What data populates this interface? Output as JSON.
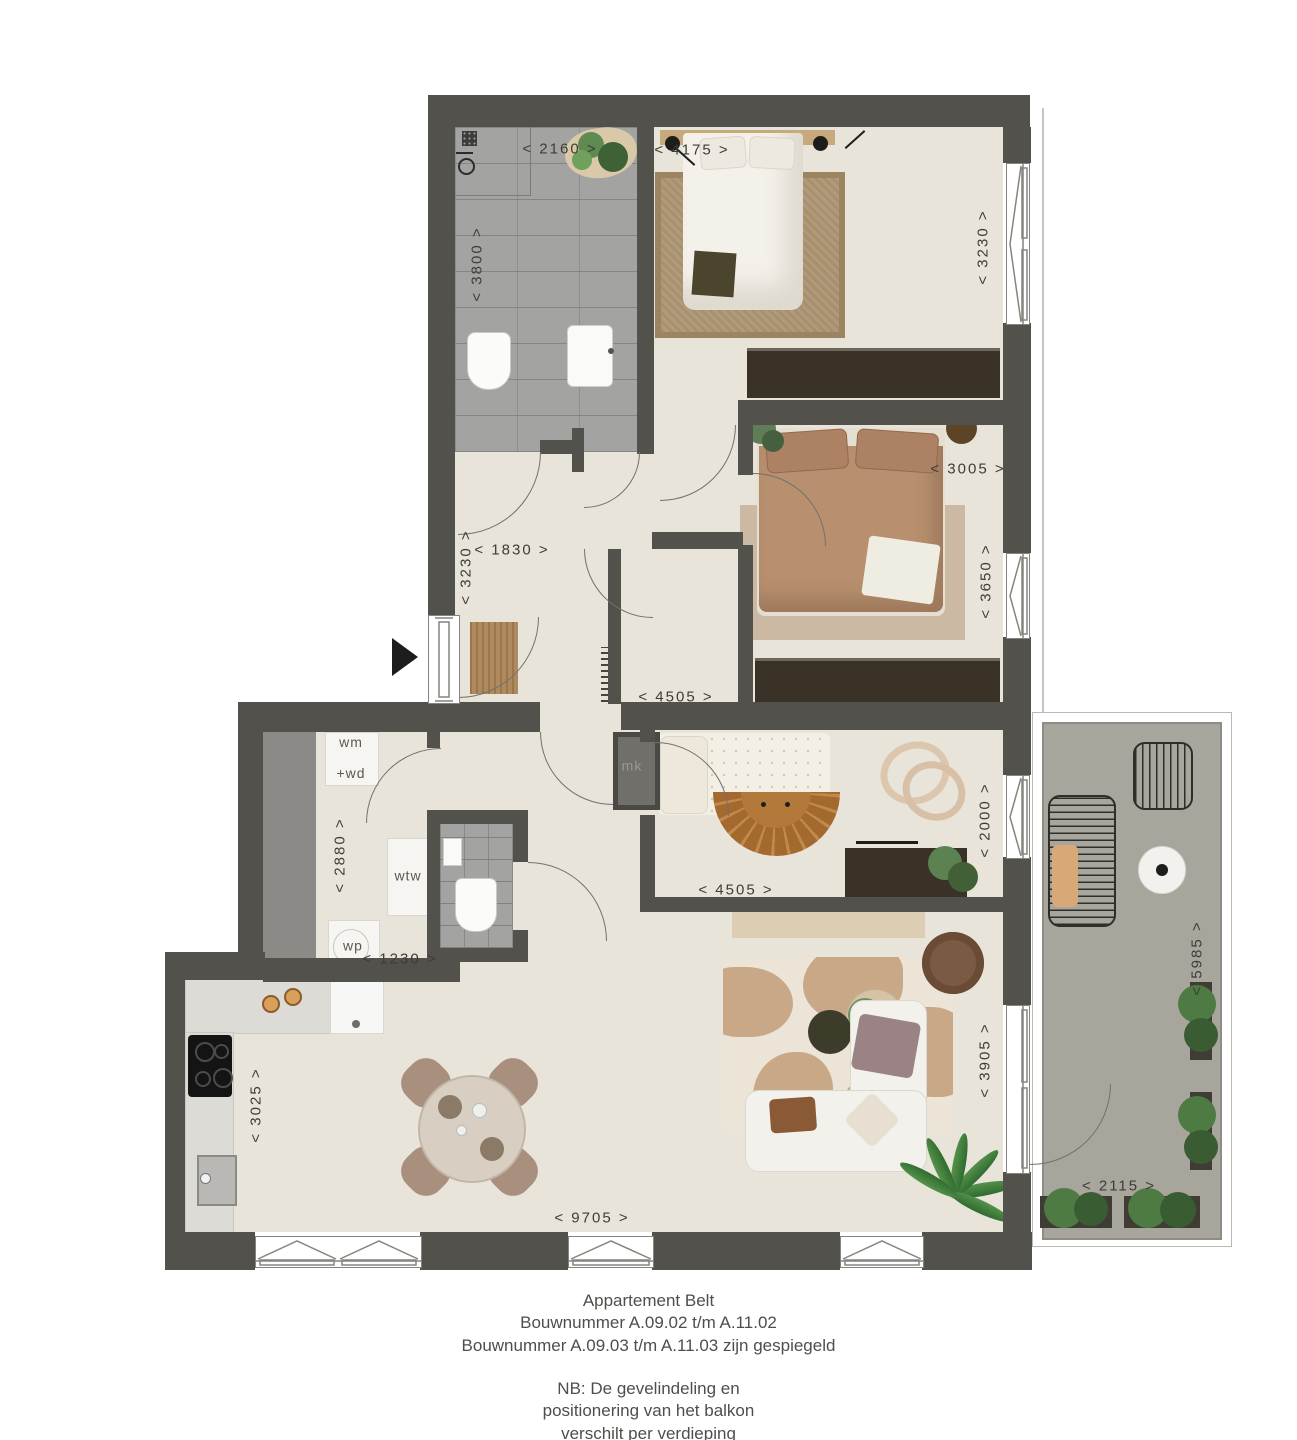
{
  "title": "Appartement Belt floor plan",
  "dims": {
    "bath_w": "< 2160 >",
    "bath_h": "< 3800 >",
    "bed1_w": "< 4175 >",
    "bed1_h": "< 3230 >",
    "bed2_w": "< 3005 >",
    "bed2_h": "< 3650 >",
    "bed2_w2": "< 4505 >",
    "hall_w": "< 1830 >",
    "hall_h": "< 3230 >",
    "kids_w": "< 4505 >",
    "kids_h": "< 2000 >",
    "util_h": "< 2880 >",
    "util_w": "< 1230 >",
    "kitchen_h": "< 3025 >",
    "living_w": "< 9705 >",
    "living_h": "< 3905 >",
    "balcony_h": "< 5985 >",
    "balcony_w": "< 2115 >"
  },
  "labels": {
    "wm1": "wm",
    "wm2": "+wd",
    "wtw": "wtw",
    "wp": "wp",
    "mk": "mk"
  },
  "caption": {
    "line1": "Appartement Belt",
    "line2": "Bouwnummer A.09.02 t/m A.11.02",
    "line3": "Bouwnummer A.09.03 t/m A.11.03 zijn gespiegeld",
    "nb1": "NB: De gevelindeling en",
    "nb2": "positionering van het balkon",
    "nb3": "verschilt per verdieping"
  },
  "colors": {
    "wall": "#53514b",
    "floor": "#e9e4d9",
    "tile": "#a3a3a1",
    "balcony": "#a8a69c",
    "dark": "#3a3226",
    "rug": "#a8906f",
    "ink": "#3c3c38"
  }
}
